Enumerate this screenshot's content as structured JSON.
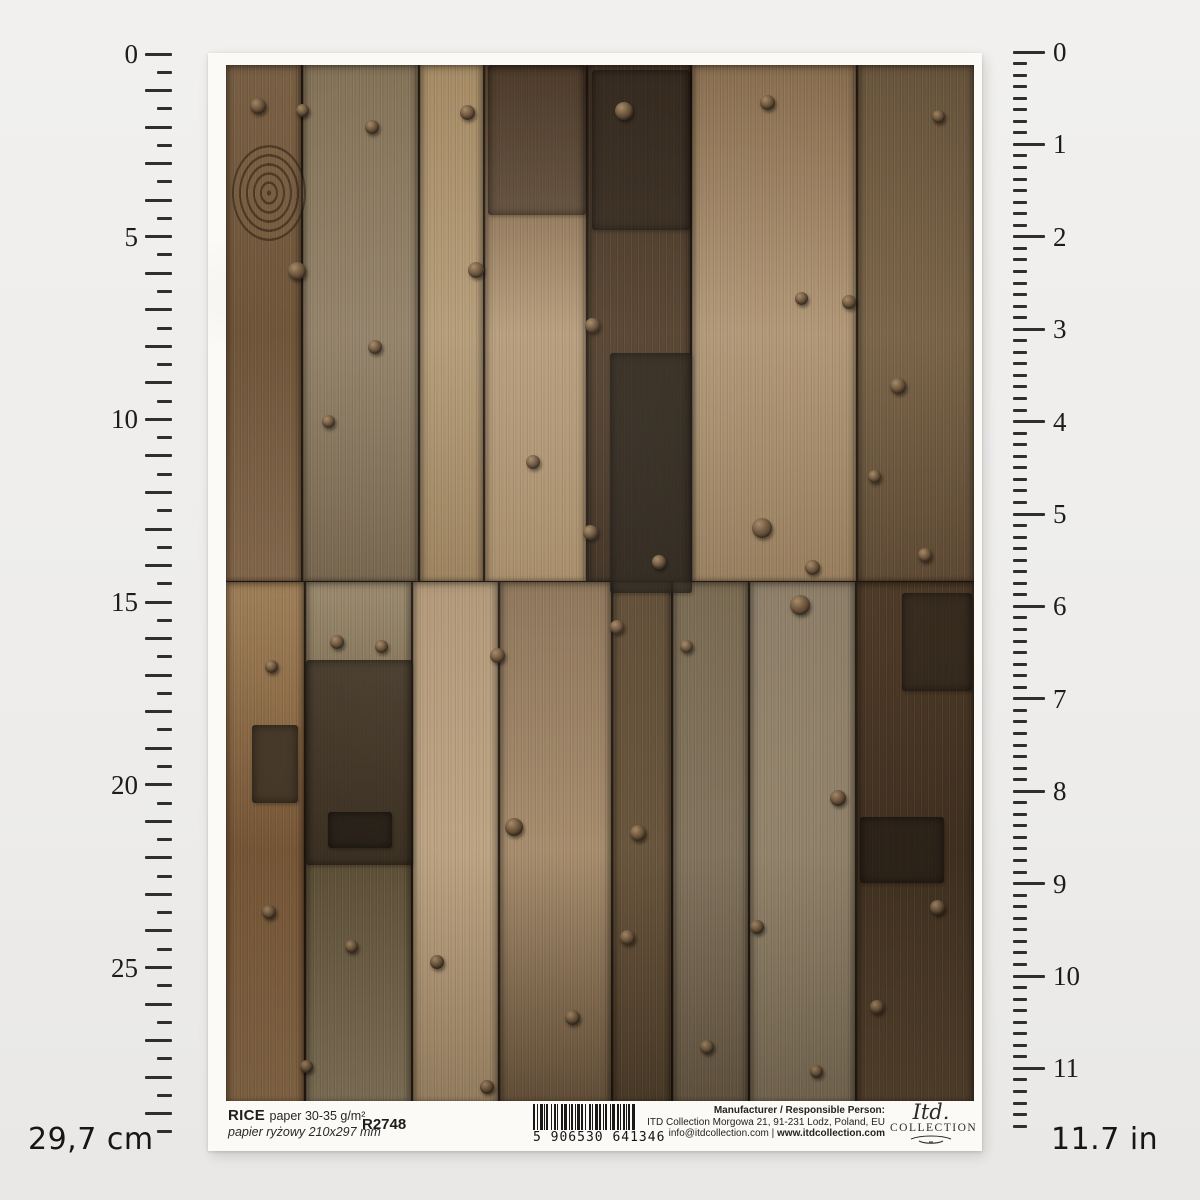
{
  "page": {
    "background": "#eeedeb",
    "description": "rice paper product sheet with cm and inch rulers"
  },
  "rulers": {
    "cm": {
      "label": "29,7 cm",
      "numbers": [
        0,
        5,
        10,
        15,
        20,
        25
      ],
      "max_value_cm": 29.7,
      "ticks_per_cm": 2
    },
    "inch": {
      "label": "11.7 in",
      "numbers": [
        0,
        1,
        2,
        3,
        4,
        5,
        6,
        7,
        8,
        9,
        10,
        11
      ],
      "max_value_in": 11.7,
      "ticks_per_in": 8
    }
  },
  "footer": {
    "product_name": "RICE",
    "product_spec": "paper 30-35 g/m²",
    "product_spec_pl": "papier ryżowy 210x297 mm",
    "product_code": "R2748",
    "barcode_digits": "5 906530 641346",
    "manufacturer_heading": "Manufacturer / Responsible Person:",
    "manufacturer_address": "ITD Collection Morgowa 21, 91-231 Lodz, Poland, EU",
    "contact_email": "info@itdcollection.com",
    "contact_separator": "|",
    "contact_web": "www.itdcollection.com",
    "logo_script": "Itd.",
    "logo_name": "COLLECTION"
  },
  "barcode_pattern": [
    [
      2,
      2
    ],
    [
      1,
      2
    ],
    [
      3,
      1
    ],
    [
      1,
      1
    ],
    [
      2,
      3
    ],
    [
      1,
      2
    ],
    [
      2,
      1
    ],
    [
      1,
      3
    ],
    [
      2,
      1
    ],
    [
      3,
      2
    ],
    [
      1,
      1
    ],
    [
      2,
      2
    ],
    [
      1,
      1
    ],
    [
      3,
      1
    ],
    [
      2,
      2
    ],
    [
      1,
      3
    ],
    [
      2,
      1
    ],
    [
      1,
      2
    ],
    [
      3,
      1
    ],
    [
      2,
      2
    ],
    [
      1,
      1
    ],
    [
      2,
      3
    ],
    [
      1,
      1
    ],
    [
      3,
      2
    ],
    [
      2,
      1
    ],
    [
      1,
      2
    ],
    [
      2,
      1
    ],
    [
      1,
      1
    ],
    [
      2,
      2
    ],
    [
      3,
      0
    ]
  ],
  "artwork": {
    "subject": "old weathered wooden planks with iron rivets, two stacked photo tiles",
    "gap_color": "#1f1710",
    "tiles": [
      {
        "height": 516,
        "planks": [
          {
            "w": 77,
            "colors": [
              "#7d6347",
              "#6f5538",
              "#81664a"
            ]
          },
          {
            "w": 117,
            "colors": [
              "#857459",
              "#94836a",
              "#76654d"
            ]
          },
          {
            "w": 65,
            "colors": [
              "#a78c66",
              "#b59c78",
              "#9c815c"
            ]
          },
          {
            "w": 103,
            "colors": [
              "#6b5138",
              "#b79d7b",
              "#a78c68"
            ]
          },
          {
            "w": 104,
            "colors": [
              "#463526",
              "#55422e",
              "#3f3022"
            ]
          },
          {
            "w": 166,
            "colors": [
              "#8a6f50",
              "#b29877",
              "#987e5d"
            ]
          },
          {
            "w": 116,
            "colors": [
              "#6e5940",
              "#7c664a",
              "#5f4b35"
            ]
          }
        ]
      },
      {
        "height": 520,
        "planks": [
          {
            "w": 80,
            "colors": [
              "#a08059",
              "#7c5a39",
              "#8f6f4c"
            ]
          },
          {
            "w": 107,
            "colors": [
              "#9b8a6e",
              "#5f5138",
              "#8a7a5f"
            ]
          },
          {
            "w": 87,
            "colors": [
              "#b29878",
              "#bfa685",
              "#a68c6a"
            ]
          },
          {
            "w": 113,
            "colors": [
              "#8d7458",
              "#a98f6f",
              "#6d573e"
            ]
          },
          {
            "w": 60,
            "colors": [
              "#5f4c35",
              "#6b573e",
              "#51402c"
            ]
          },
          {
            "w": 77,
            "colors": [
              "#77684f",
              "#857660",
              "#6a5b45"
            ]
          },
          {
            "w": 107,
            "colors": [
              "#8d7e68",
              "#97886f",
              "#7f7058"
            ]
          },
          {
            "w": 117,
            "colors": [
              "#4f3b28",
              "#443322",
              "#5a4630"
            ]
          }
        ]
      }
    ],
    "knot": {
      "x": 6,
      "y": 80,
      "w": 74,
      "h": 96
    },
    "patches": [
      {
        "x": 262,
        "y": 0,
        "w": 98,
        "h": 150,
        "color": "rgba(40,32,24,0.45)"
      },
      {
        "x": 366,
        "y": 5,
        "w": 98,
        "h": 160,
        "color": "rgba(35,30,24,0.50)"
      },
      {
        "x": 384,
        "y": 288,
        "w": 82,
        "h": 240,
        "color": "rgba(42,36,28,0.72)"
      },
      {
        "x": 80,
        "y": 595,
        "w": 106,
        "h": 205,
        "color": "rgba(48,39,28,0.70)"
      },
      {
        "x": 102,
        "y": 747,
        "w": 64,
        "h": 36,
        "color": "rgba(40,33,25,0.85)"
      },
      {
        "x": 26,
        "y": 660,
        "w": 46,
        "h": 78,
        "color": "rgba(66,54,40,0.92)"
      },
      {
        "x": 634,
        "y": 752,
        "w": 84,
        "h": 66,
        "color": "rgba(40,32,24,0.75)"
      },
      {
        "x": 676,
        "y": 528,
        "w": 70,
        "h": 98,
        "color": "rgba(45,37,28,0.65)"
      }
    ],
    "rivets": [
      [
        24,
        33,
        16
      ],
      [
        70,
        39,
        13
      ],
      [
        139,
        55,
        14
      ],
      [
        234,
        40,
        15
      ],
      [
        389,
        37,
        18
      ],
      [
        534,
        30,
        15
      ],
      [
        706,
        45,
        13
      ],
      [
        62,
        197,
        18
      ],
      [
        242,
        197,
        16
      ],
      [
        142,
        275,
        14
      ],
      [
        359,
        253,
        15
      ],
      [
        569,
        227,
        13
      ],
      [
        616,
        230,
        14
      ],
      [
        664,
        313,
        16
      ],
      [
        96,
        350,
        13
      ],
      [
        300,
        390,
        14
      ],
      [
        642,
        405,
        13
      ],
      [
        357,
        460,
        15
      ],
      [
        526,
        453,
        20
      ],
      [
        426,
        490,
        14
      ],
      [
        579,
        495,
        15
      ],
      [
        692,
        483,
        14
      ],
      [
        39,
        595,
        13
      ],
      [
        104,
        570,
        14
      ],
      [
        149,
        575,
        13
      ],
      [
        264,
        583,
        15
      ],
      [
        384,
        555,
        14
      ],
      [
        564,
        530,
        20
      ],
      [
        454,
        575,
        13
      ],
      [
        279,
        753,
        18
      ],
      [
        404,
        760,
        16
      ],
      [
        604,
        725,
        16
      ],
      [
        36,
        840,
        14
      ],
      [
        119,
        875,
        13
      ],
      [
        204,
        890,
        14
      ],
      [
        394,
        865,
        15
      ],
      [
        524,
        855,
        14
      ],
      [
        704,
        835,
        15
      ],
      [
        339,
        945,
        15
      ],
      [
        474,
        975,
        14
      ],
      [
        644,
        935,
        14
      ],
      [
        74,
        995,
        13
      ],
      [
        254,
        1015,
        14
      ],
      [
        584,
        1000,
        13
      ]
    ]
  }
}
